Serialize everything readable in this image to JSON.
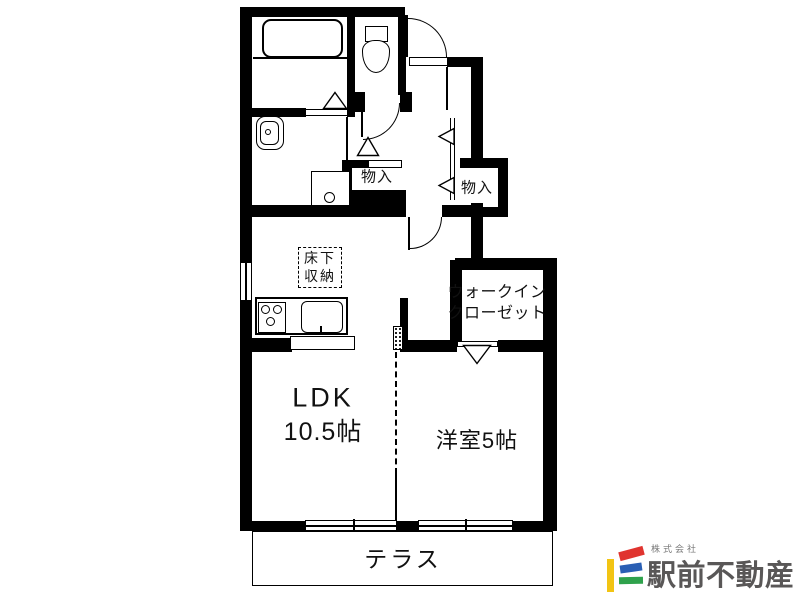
{
  "plan": {
    "rooms": {
      "ldk": {
        "name": "LDK",
        "size": "10.5帖"
      },
      "western": {
        "label": "洋室5帖"
      },
      "wic": {
        "line1": "ウォークイン",
        "line2": "クローゼット"
      },
      "terrace": {
        "label": "テラス"
      },
      "storage_hall": {
        "label": "物入"
      },
      "storage_mid": {
        "label": "物入"
      },
      "underfloor": {
        "line1": "床下",
        "line2": "収納"
      }
    }
  },
  "logo": {
    "prefix": "株式会社",
    "name": "駅前不動産"
  },
  "colors": {
    "wall": "#000000",
    "text": "#111111",
    "logo_gray": "#595757",
    "logo_prefix_gray": "#777777",
    "logo_yellow": "#f2c413",
    "logo_red": "#e0342f",
    "logo_blue": "#2a5fb4",
    "logo_green": "#2fa24c"
  }
}
